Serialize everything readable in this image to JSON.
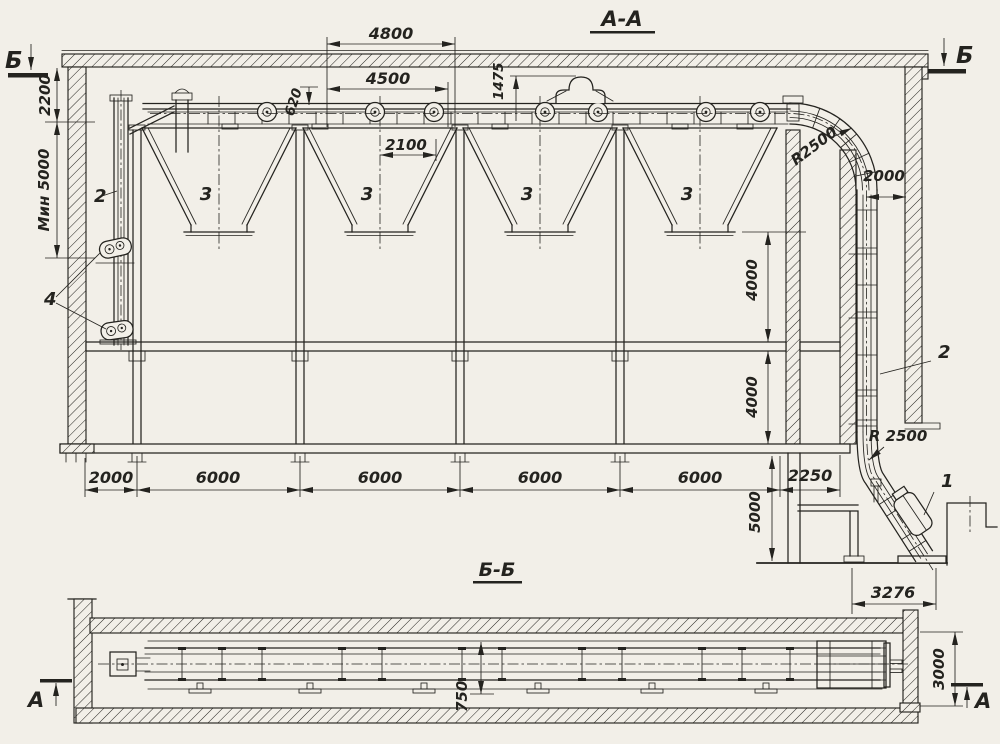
{
  "page": {
    "bg": "#f2efe8",
    "ink": "#24231f"
  },
  "views": {
    "aa": {
      "title": "А-А"
    },
    "bb": {
      "title": "Б-Б"
    }
  },
  "marks": {
    "section_b": "Б",
    "section_a": "А"
  },
  "parts": {
    "p1": "1",
    "p2": "2",
    "p3": "3",
    "p4": "4"
  },
  "dims": {
    "top_4800": "4800",
    "top_4500": "4500",
    "top_620": "620",
    "top_1475": "1475",
    "top_2100": "2100",
    "left_2200": "2200",
    "left_min5000": "Мин 5000",
    "right_2000": "2000",
    "radius_top": "R2500",
    "radius_bottom": "R 2500",
    "right_4000": "4000",
    "pit_5000": "5000",
    "pit_3276": "3276",
    "chain": [
      "2000",
      "6000",
      "6000",
      "6000",
      "6000",
      "2250"
    ],
    "bb_750": "750",
    "bb_3000": "3000"
  }
}
